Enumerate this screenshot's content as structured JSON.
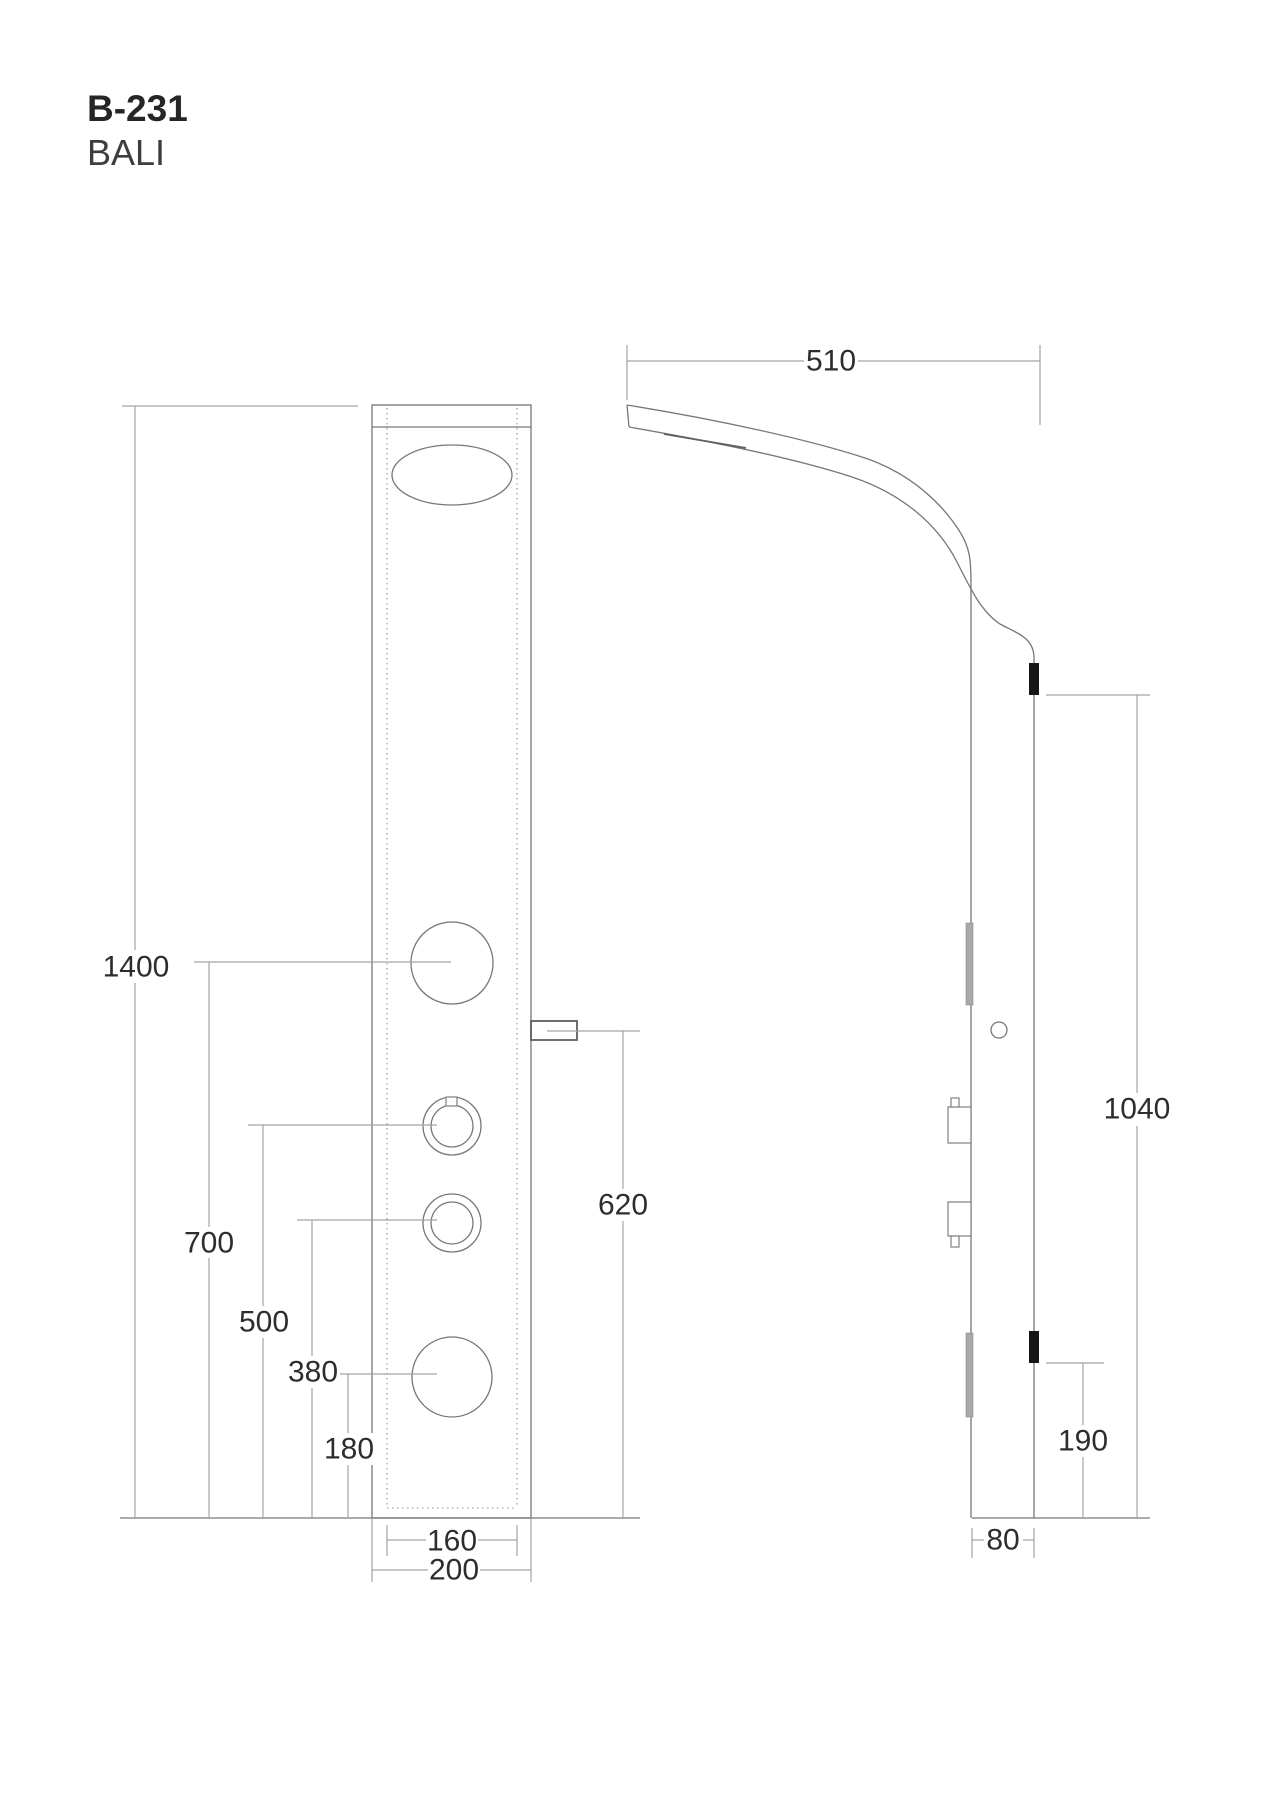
{
  "title": {
    "model": "B-231",
    "product_name": "BALI"
  },
  "front_view": {
    "dimensions": {
      "panel_height": "1400",
      "upper_jet_height": "700",
      "upper_knob_height": "500",
      "lower_knob_height": "380",
      "lower_jet_height": "180",
      "spout_height": "620",
      "inner_width": "160",
      "panel_width": "200"
    }
  },
  "side_view": {
    "dimensions": {
      "head_projection": "510",
      "upper_bracket_height": "1040",
      "lower_bracket_height": "190",
      "panel_depth": "80"
    }
  },
  "colors": {
    "background": "#ffffff",
    "outline": "#777777",
    "dimension_line": "#a0a4a7",
    "text": "#2d2d2d",
    "bracket_mark": "#161616",
    "side_bar": "#a9a9a9"
  }
}
